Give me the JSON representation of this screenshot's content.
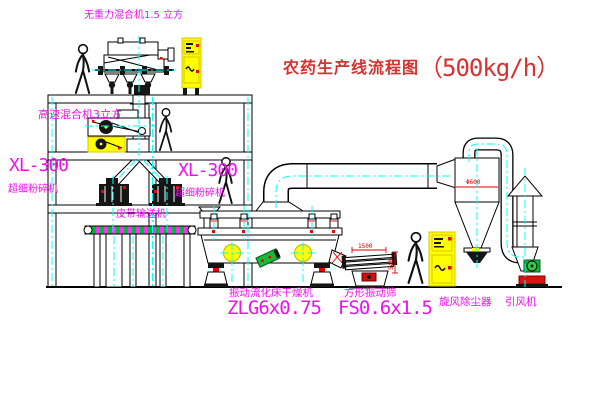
{
  "title": {
    "name": "农药生产线流程图",
    "capacity": "（500kg/h）"
  },
  "labels": {
    "weightless_mixer": "无重力混合机1.5 立方",
    "high_speed_mixer": "高速混合机3立方",
    "pulverizer_left_model": "XL-300",
    "pulverizer_left_name": "超细粉碎机",
    "pulverizer_center_model": "XL-300",
    "pulverizer_center_name": "超细粉碎机",
    "belt_conveyor": "皮带输送机",
    "dryer_name": "振动流化床干燥机",
    "dryer_model": "ZLG6x0.75",
    "sieve_name": "方形振动筛",
    "sieve_model": "FS0.6x1.5",
    "cyclone_name": "旋风除尘器",
    "fan_name": "引风机"
  },
  "dimensions": {
    "sieve_length": "1500",
    "sieve_height": "540",
    "cyclone_marking": "Φ600"
  },
  "colors": {
    "label_magenta": "#ee10ee",
    "title_red": "#d93030",
    "centerline_cyan": "#00ffff",
    "cabinet_yellow": "#ffff00",
    "accent_red": "#ee0000",
    "motor_green": "#11bb33"
  }
}
